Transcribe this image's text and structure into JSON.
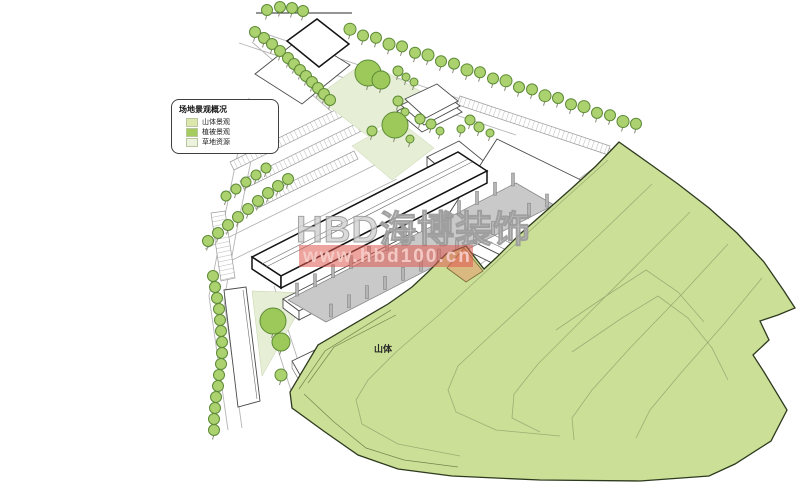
{
  "legend": {
    "title": "场地景观概况",
    "items": [
      {
        "label": "山体景观",
        "color": "#dbe7ad"
      },
      {
        "label": "植被景观",
        "color": "#a6cb5f"
      },
      {
        "label": "草地资源",
        "color": "#edf2df"
      }
    ]
  },
  "labels": {
    "mountain": "山体"
  },
  "watermark": {
    "brand": "HBD海博装饰",
    "url": "www.hbd100.cn",
    "band_color": "#df5a50",
    "brand_color": "#cfcfcf",
    "url_text_color": "#f6cbc6"
  },
  "colors": {
    "tree": "#abd26e",
    "tree_big": "#9cc95a",
    "mountain": "#cbdf97",
    "lawn": "#e6efd6",
    "platform": "#c9c9c9",
    "column": "#b5b5b5",
    "slope": "#d9b97f"
  }
}
